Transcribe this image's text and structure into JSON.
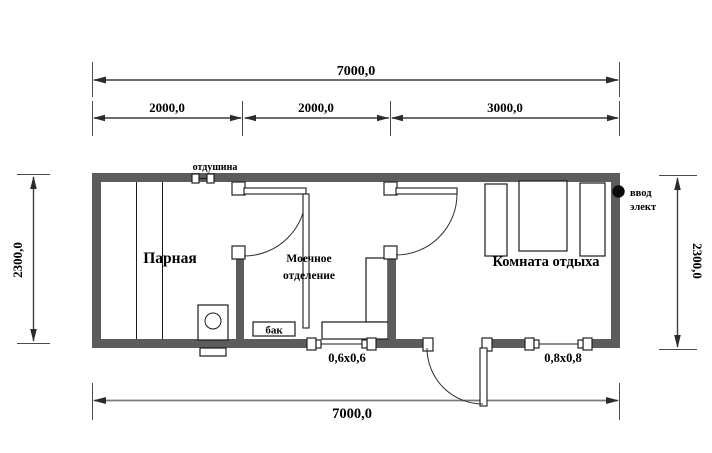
{
  "diagram_type": "floor-plan",
  "colors": {
    "wall": "#5c5c5c",
    "line": "#3d3d3d",
    "text": "#000000",
    "background": "#ffffff"
  },
  "dims": {
    "top_overall": "7000,0",
    "seg1": "2000,0",
    "seg2": "2000,0",
    "seg3": "3000,0",
    "left_height": "2300,0",
    "right_height": "2300,0",
    "bottom_overall": "7000,0"
  },
  "rooms": {
    "steam": "Парная",
    "washing_line1": "Моечное",
    "washing_line2": "отделение",
    "rest": "Комната отдыха"
  },
  "labels": {
    "vent": "отдушина",
    "tank": "бак",
    "electric_line1": "ввод",
    "electric_line2": "элект",
    "window_small": "0,6х0,6",
    "window_large": "0,8х0,8"
  }
}
